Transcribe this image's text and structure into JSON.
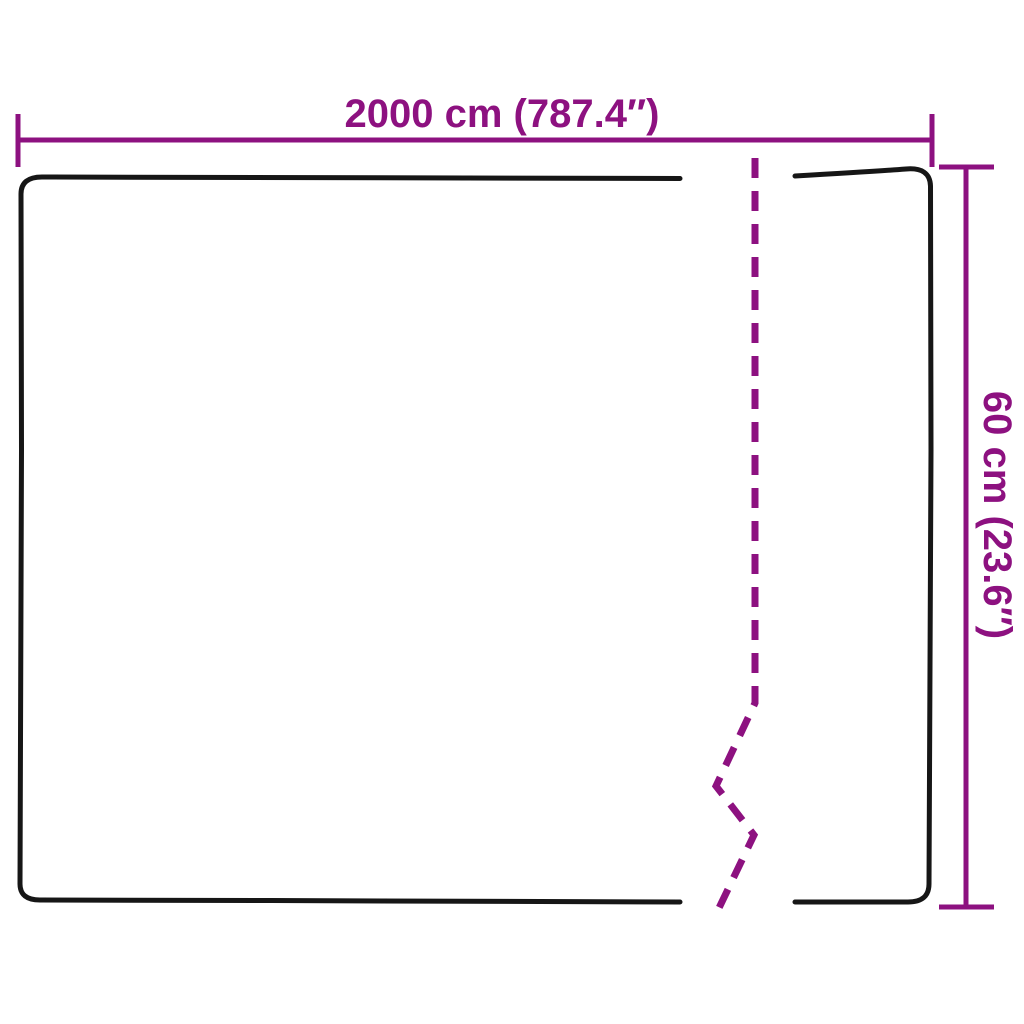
{
  "diagram": {
    "width_label": "2000 cm (787.4″)",
    "height_label": "60 cm (23.6″)",
    "dimension_color": "#8D1180",
    "outline_color": "#161616",
    "background_color": "#ffffff"
  }
}
